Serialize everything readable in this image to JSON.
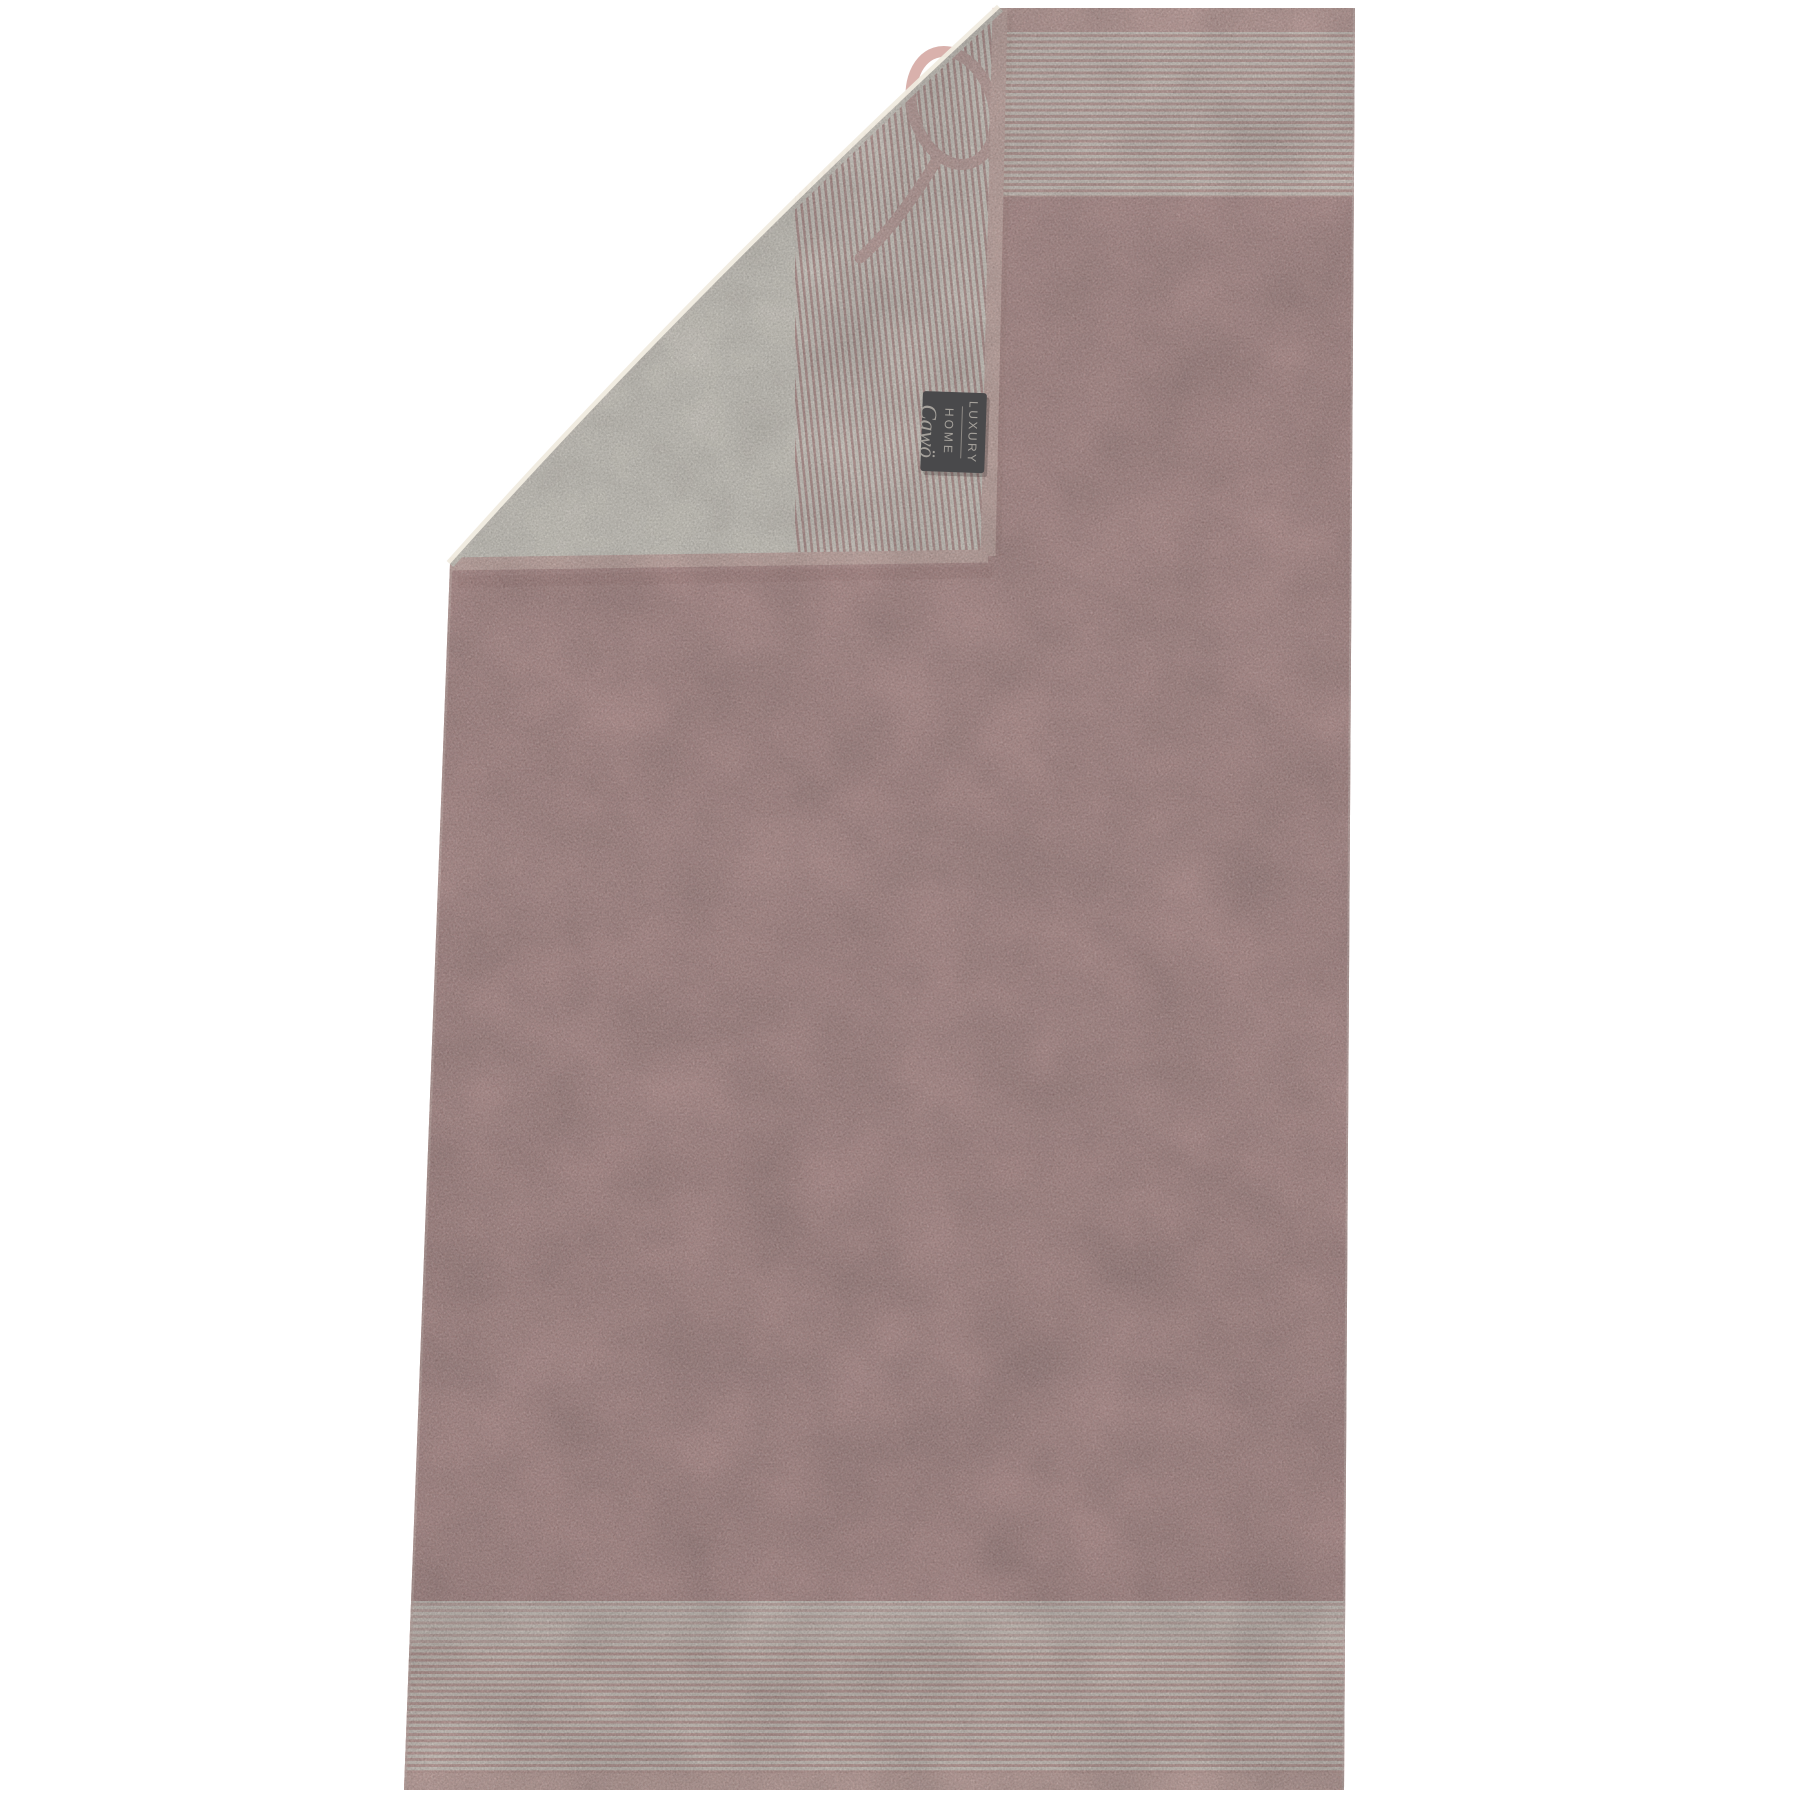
{
  "scene": {
    "background_color": "#ffffff"
  },
  "brand_label": {
    "line1": "LUXURY",
    "line2": "HOME",
    "brand": "Cawö",
    "bg_color": "#49494b",
    "text_color": "#a5a19b"
  },
  "css_vars": {
    "--bg": "#ffffff",
    "--body-pink": "#c69795",
    "--hem-pink": "#d7a9a4",
    "--hem-pink-light": "#ddb3ad",
    "--hem-edge": "#e3bdb6",
    "--stripe-cream": "#efe3d9",
    "--stripe-pink": "#d5a8a2",
    "--back-cream": "#f0ebdf",
    "--back-stripe-cream": "#f2ece1",
    "--back-stripe-pink": "#c99d99",
    "--loop-pink": "#d9b1ac",
    "--edge-light-left": "#e7c6c0",
    "--edge-light-right": "#ecd3cd",
    "--soft-shadow": "rgba(133, 82, 77, 0.28)",
    "--label-bg": "#49494b",
    "--label-shadow": "rgba(40, 30, 30, 0.25)",
    "--label-text": "#a5a19b",
    "--label-rule": "#8d8984"
  }
}
